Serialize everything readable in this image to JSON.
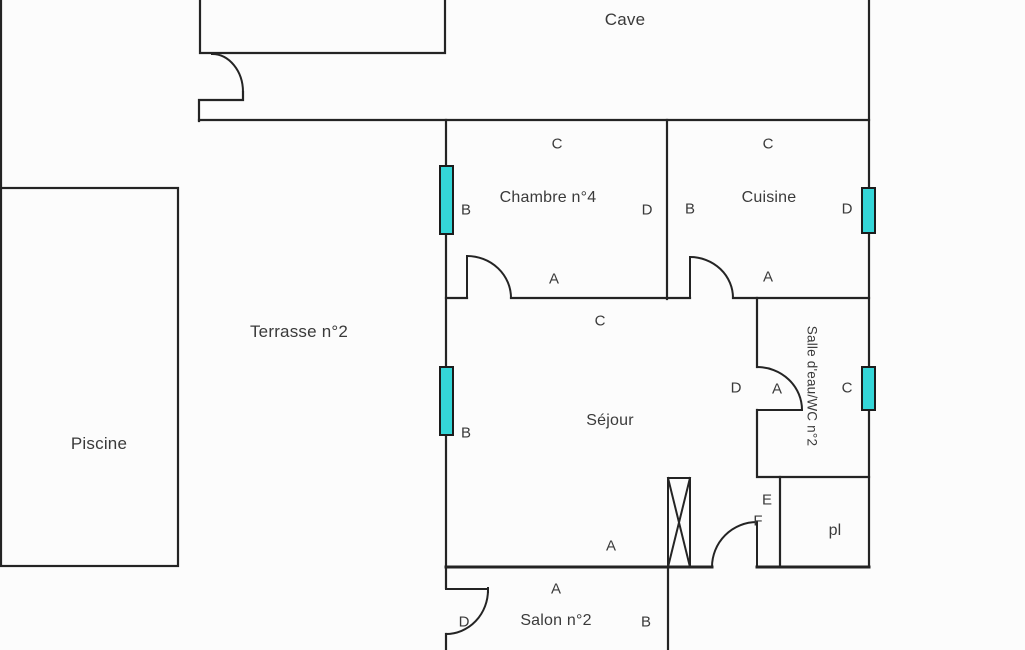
{
  "floorplan": {
    "colors": {
      "wall": "#242424",
      "window_fill": "#34d6d8",
      "window_border": "#1c1c1c",
      "text": "#3a3a3a",
      "background": "#fcfcfc"
    },
    "rooms": [
      {
        "id": "cave",
        "label": "Cave",
        "x": 625,
        "y": 20,
        "size": 17,
        "vertical": false
      },
      {
        "id": "chambre-n4",
        "label": "Chambre n°4",
        "x": 548,
        "y": 198,
        "size": 16,
        "vertical": false
      },
      {
        "id": "cuisine",
        "label": "Cuisine",
        "x": 769,
        "y": 198,
        "size": 16,
        "vertical": false
      },
      {
        "id": "terrasse-n2",
        "label": "Terrasse n°2",
        "x": 299,
        "y": 332,
        "size": 17,
        "vertical": false
      },
      {
        "id": "piscine",
        "label": "Piscine",
        "x": 99,
        "y": 444,
        "size": 17,
        "vertical": false
      },
      {
        "id": "sejour",
        "label": "Séjour",
        "x": 610,
        "y": 421,
        "size": 16,
        "vertical": false
      },
      {
        "id": "salle-deau-wc-n2",
        "label": "Salle d'eau/WC n°2",
        "x": 812,
        "y": 386,
        "size": 13.5,
        "vertical": true
      },
      {
        "id": "placard",
        "label": "pl",
        "x": 835,
        "y": 531,
        "size": 16,
        "vertical": false
      },
      {
        "id": "salon-n2",
        "label": "Salon n°2",
        "x": 556,
        "y": 621,
        "size": 16,
        "vertical": false
      }
    ],
    "wall_letters": [
      {
        "letter": "C",
        "x": 557,
        "y": 144
      },
      {
        "letter": "B",
        "x": 466,
        "y": 210
      },
      {
        "letter": "D",
        "x": 647,
        "y": 210
      },
      {
        "letter": "A",
        "x": 554,
        "y": 279
      },
      {
        "letter": "C",
        "x": 768,
        "y": 144
      },
      {
        "letter": "B",
        "x": 690,
        "y": 209
      },
      {
        "letter": "D",
        "x": 847,
        "y": 209
      },
      {
        "letter": "A",
        "x": 768,
        "y": 277
      },
      {
        "letter": "C",
        "x": 600,
        "y": 321
      },
      {
        "letter": "B",
        "x": 466,
        "y": 433
      },
      {
        "letter": "A",
        "x": 611,
        "y": 546
      },
      {
        "letter": "D",
        "x": 736,
        "y": 388
      },
      {
        "letter": "A",
        "x": 777,
        "y": 389
      },
      {
        "letter": "C",
        "x": 847,
        "y": 388
      },
      {
        "letter": "E",
        "x": 767,
        "y": 500
      },
      {
        "letter": "F",
        "x": 758,
        "y": 521
      },
      {
        "letter": "A",
        "x": 556,
        "y": 589
      },
      {
        "letter": "D",
        "x": 464,
        "y": 622
      },
      {
        "letter": "B",
        "x": 646,
        "y": 622
      }
    ]
  }
}
